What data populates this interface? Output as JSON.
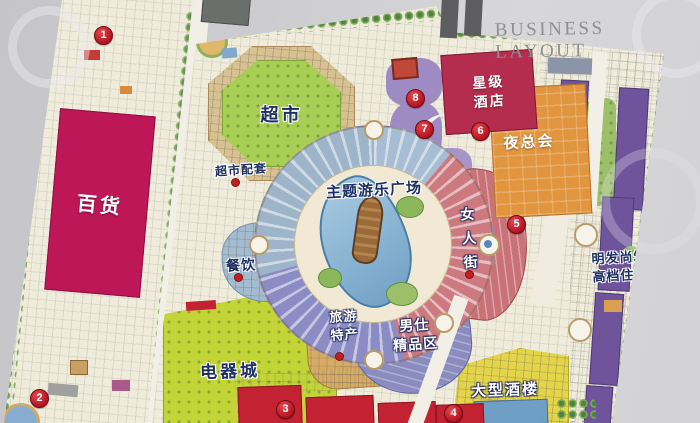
{
  "header": {
    "title": "BUSINESS LAYOUT"
  },
  "markers": [
    "1",
    "2",
    "3",
    "4",
    "5",
    "6",
    "7",
    "8"
  ],
  "zones": {
    "department_store": "百货",
    "supermarket": "超市",
    "supermarket_support": "超市配套",
    "theme_plaza": "主题游乐广场",
    "dining": "餐饮",
    "electronics_city": "电器城",
    "tourism_line1": "旅游",
    "tourism_line2": "特产",
    "mens_line1": "男仕",
    "mens_line2": "精品区",
    "womens_street": "女人街",
    "hotel_line1": "星级",
    "hotel_line2": "酒店",
    "nightclub": "夜总会",
    "residence_line1": "明发尚筑",
    "residence_line2": "高档住宅",
    "restaurant": "大型酒楼"
  },
  "colors": {
    "department_store_magenta": "#bd1758",
    "supermarket_green": "#a8cf54",
    "electronics_chartreuse": "#c3d437",
    "hotel_crimson": "#b42c4e",
    "nightclub_orange": "#e2953f",
    "residence_purple": "#6f549c",
    "womens_street_pink": "#c97278",
    "mens_boutique_violet": "#8a8cc0",
    "dining_bluegray": "#a4bcd0",
    "restaurant_yellow": "#e3d44a",
    "marker_red": "#c5202c",
    "lake_blue": "#8fb6d6"
  }
}
